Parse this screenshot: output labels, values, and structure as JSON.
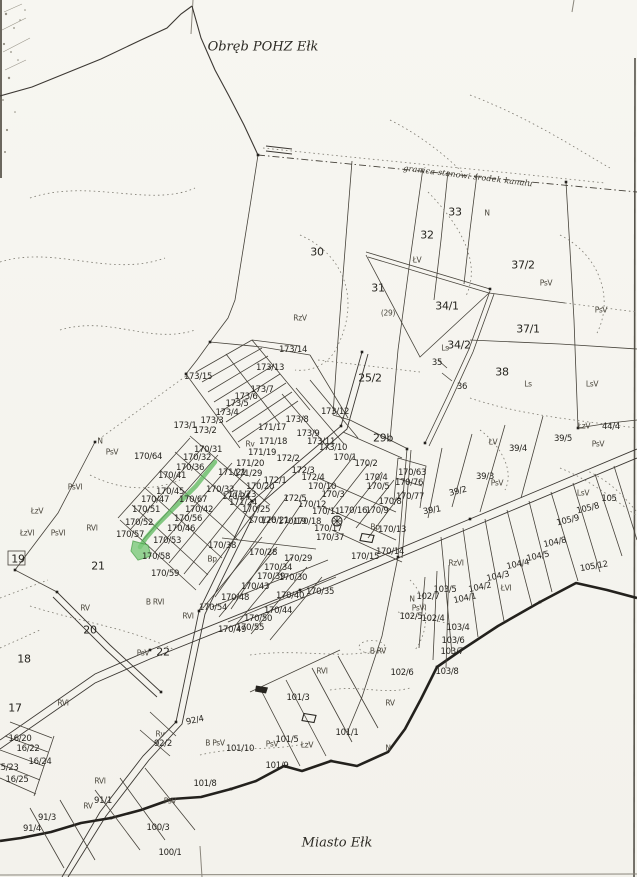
{
  "map": {
    "region_title": "Obręb POHZ Ełk",
    "city_title": "Miasto Ełk",
    "boundary_note": "granica stanowi środek kanału",
    "highlight_color": "#5cb85c",
    "highlight_fill": "#7ccb7c"
  },
  "highlight": {
    "line_points": "215,462 196,486 176,506 158,524 146,538 140,547",
    "blob_points": "133,541 148,545 151,556 138,560 131,551"
  },
  "labels": [
    {
      "t": "30",
      "x": 317,
      "y": 252,
      "c": "b"
    },
    {
      "t": "31",
      "x": 378,
      "y": 288,
      "c": "b"
    },
    {
      "t": "(29)",
      "x": 388,
      "y": 313,
      "c": "u"
    },
    {
      "t": "32",
      "x": 427,
      "y": 235,
      "c": "b"
    },
    {
      "t": "33",
      "x": 455,
      "y": 212,
      "c": "b"
    },
    {
      "t": "N",
      "x": 487,
      "y": 213,
      "c": "u"
    },
    {
      "t": "ŁV",
      "x": 417,
      "y": 260,
      "c": "u"
    },
    {
      "t": "RzV",
      "x": 300,
      "y": 318,
      "c": "u"
    },
    {
      "t": "34/1",
      "x": 447,
      "y": 306,
      "c": "b"
    },
    {
      "t": "Ls",
      "x": 445,
      "y": 348,
      "c": "u"
    },
    {
      "t": "34/2",
      "x": 459,
      "y": 345,
      "c": "b"
    },
    {
      "t": "35",
      "x": 437,
      "y": 363
    },
    {
      "t": "36",
      "x": 462,
      "y": 387
    },
    {
      "t": "37/2",
      "x": 523,
      "y": 265,
      "c": "b"
    },
    {
      "t": "PsV",
      "x": 546,
      "y": 283,
      "c": "u"
    },
    {
      "t": "PsV",
      "x": 601,
      "y": 310,
      "c": "u"
    },
    {
      "t": "37/1",
      "x": 528,
      "y": 329,
      "c": "b"
    },
    {
      "t": "38",
      "x": 502,
      "y": 372,
      "c": "b"
    },
    {
      "t": "Ls",
      "x": 528,
      "y": 384,
      "c": "u"
    },
    {
      "t": "LsV",
      "x": 592,
      "y": 384,
      "c": "u"
    },
    {
      "t": "25/2",
      "x": 370,
      "y": 378,
      "c": "b"
    },
    {
      "t": "29b",
      "x": 383,
      "y": 438,
      "c": "b"
    },
    {
      "t": "ŁzV",
      "x": 584,
      "y": 426,
      "c": "u"
    },
    {
      "t": "44/4",
      "x": 611,
      "y": 427
    },
    {
      "t": "39/5",
      "x": 563,
      "y": 439
    },
    {
      "t": "PsV",
      "x": 598,
      "y": 444,
      "c": "u"
    },
    {
      "t": "ŁV",
      "x": 493,
      "y": 442,
      "c": "u"
    },
    {
      "t": "39/4",
      "x": 518,
      "y": 449
    },
    {
      "t": "39/3",
      "x": 485,
      "y": 477
    },
    {
      "t": "PsV",
      "x": 497,
      "y": 483,
      "c": "u"
    },
    {
      "t": "39/2",
      "x": 458,
      "y": 492,
      "r": -14
    },
    {
      "t": "39/1",
      "x": 432,
      "y": 511,
      "r": -10
    },
    {
      "t": "LsV",
      "x": 583,
      "y": 493,
      "c": "u"
    },
    {
      "t": "105",
      "x": 609,
      "y": 499
    },
    {
      "t": "105/8",
      "x": 588,
      "y": 509,
      "r": -14
    },
    {
      "t": "105/9",
      "x": 568,
      "y": 521,
      "r": -14
    },
    {
      "t": "105/12",
      "x": 594,
      "y": 567,
      "r": -10
    },
    {
      "t": "104/8",
      "x": 555,
      "y": 543,
      "r": -12
    },
    {
      "t": "104/5",
      "x": 538,
      "y": 557,
      "r": -12
    },
    {
      "t": "104/4",
      "x": 518,
      "y": 565,
      "r": -12
    },
    {
      "t": "104/3",
      "x": 498,
      "y": 577,
      "r": -12
    },
    {
      "t": "104/2",
      "x": 480,
      "y": 588,
      "r": -12
    },
    {
      "t": "ŁVI",
      "x": 506,
      "y": 588,
      "c": "u"
    },
    {
      "t": "104/1",
      "x": 465,
      "y": 599,
      "r": -12
    },
    {
      "t": "RzVI",
      "x": 456,
      "y": 563,
      "c": "u"
    },
    {
      "t": "103/5",
      "x": 445,
      "y": 590
    },
    {
      "t": "102/7",
      "x": 428,
      "y": 597
    },
    {
      "t": "N",
      "x": 412,
      "y": 599,
      "c": "u"
    },
    {
      "t": "PsVI",
      "x": 419,
      "y": 608,
      "c": "u"
    },
    {
      "t": "102/5",
      "x": 411,
      "y": 617
    },
    {
      "t": "102/4",
      "x": 433,
      "y": 619
    },
    {
      "t": "103/4",
      "x": 458,
      "y": 628
    },
    {
      "t": "103/6",
      "x": 453,
      "y": 641
    },
    {
      "t": "103/7",
      "x": 452,
      "y": 652
    },
    {
      "t": "103/8",
      "x": 447,
      "y": 672
    },
    {
      "t": "102/6",
      "x": 402,
      "y": 673
    },
    {
      "t": "RVI",
      "x": 322,
      "y": 671,
      "c": "u"
    },
    {
      "t": "B RV",
      "x": 378,
      "y": 651,
      "c": "u"
    },
    {
      "t": "RV",
      "x": 390,
      "y": 703,
      "c": "u"
    },
    {
      "t": "101/3",
      "x": 298,
      "y": 698
    },
    {
      "t": "101/1",
      "x": 347,
      "y": 733
    },
    {
      "t": "ŁzV",
      "x": 307,
      "y": 745,
      "c": "u"
    },
    {
      "t": "N",
      "x": 388,
      "y": 748,
      "c": "u"
    },
    {
      "t": "101/5",
      "x": 287,
      "y": 740
    },
    {
      "t": "101/10",
      "x": 240,
      "y": 749
    },
    {
      "t": "PsV",
      "x": 272,
      "y": 744,
      "c": "u"
    },
    {
      "t": "B PsV",
      "x": 215,
      "y": 743,
      "c": "u"
    },
    {
      "t": "101/9",
      "x": 277,
      "y": 766
    },
    {
      "t": "101/8",
      "x": 205,
      "y": 784
    },
    {
      "t": "100/3",
      "x": 158,
      "y": 828
    },
    {
      "t": "100/1",
      "x": 170,
      "y": 853
    },
    {
      "t": "PsV",
      "x": 170,
      "y": 801,
      "c": "u"
    },
    {
      "t": "92/4",
      "x": 195,
      "y": 721,
      "r": -12
    },
    {
      "t": "Rv",
      "x": 160,
      "y": 734,
      "c": "u"
    },
    {
      "t": "92/2",
      "x": 163,
      "y": 744
    },
    {
      "t": "91/1",
      "x": 103,
      "y": 801
    },
    {
      "t": "RV",
      "x": 88,
      "y": 806,
      "c": "u"
    },
    {
      "t": "RVI",
      "x": 100,
      "y": 781,
      "c": "u"
    },
    {
      "t": "91/3",
      "x": 47,
      "y": 818
    },
    {
      "t": "91/4",
      "x": 32,
      "y": 829
    },
    {
      "t": "16/20",
      "x": 20,
      "y": 739
    },
    {
      "t": "16/22",
      "x": 28,
      "y": 749
    },
    {
      "t": "16/24",
      "x": 40,
      "y": 762
    },
    {
      "t": "15/23",
      "x": 7,
      "y": 768
    },
    {
      "t": "16/25",
      "x": 17,
      "y": 780
    },
    {
      "t": "17",
      "x": 15,
      "y": 708,
      "c": "b"
    },
    {
      "t": "18",
      "x": 24,
      "y": 659,
      "c": "b"
    },
    {
      "t": "19",
      "x": 18,
      "y": 559,
      "c": "b"
    },
    {
      "t": "RVI",
      "x": 63,
      "y": 703,
      "c": "u"
    },
    {
      "t": "20",
      "x": 90,
      "y": 630,
      "c": "b"
    },
    {
      "t": "RV",
      "x": 85,
      "y": 608,
      "c": "u"
    },
    {
      "t": "B RVI",
      "x": 155,
      "y": 602,
      "c": "u"
    },
    {
      "t": "RVI",
      "x": 188,
      "y": 616,
      "c": "u"
    },
    {
      "t": "PsV",
      "x": 143,
      "y": 653,
      "c": "u"
    },
    {
      "t": "22",
      "x": 163,
      "y": 652,
      "c": "b"
    },
    {
      "t": "21",
      "x": 98,
      "y": 566,
      "c": "b"
    },
    {
      "t": "PsVI",
      "x": 75,
      "y": 487,
      "c": "u"
    },
    {
      "t": "ŁzV",
      "x": 37,
      "y": 511,
      "c": "u"
    },
    {
      "t": "ŁzVI",
      "x": 27,
      "y": 533,
      "c": "u"
    },
    {
      "t": "PsVI",
      "x": 58,
      "y": 533,
      "c": "u"
    },
    {
      "t": "RVI",
      "x": 92,
      "y": 528,
      "c": "u"
    },
    {
      "t": "N",
      "x": 100,
      "y": 441,
      "c": "u"
    },
    {
      "t": "PsV",
      "x": 112,
      "y": 452,
      "c": "u"
    },
    {
      "t": "173/14",
      "x": 293,
      "y": 350
    },
    {
      "t": "173/13",
      "x": 270,
      "y": 368
    },
    {
      "t": "173/15",
      "x": 198,
      "y": 377
    },
    {
      "t": "173/12",
      "x": 335,
      "y": 412
    },
    {
      "t": "173/7",
      "x": 262,
      "y": 390
    },
    {
      "t": "173/6",
      "x": 246,
      "y": 397
    },
    {
      "t": "173/5",
      "x": 237,
      "y": 404
    },
    {
      "t": "173/4",
      "x": 227,
      "y": 413
    },
    {
      "t": "173/3",
      "x": 212,
      "y": 421
    },
    {
      "t": "173/2",
      "x": 205,
      "y": 431
    },
    {
      "t": "173/1",
      "x": 185,
      "y": 426
    },
    {
      "t": "173/8",
      "x": 297,
      "y": 420
    },
    {
      "t": "173/9",
      "x": 308,
      "y": 434
    },
    {
      "t": "173/11",
      "x": 321,
      "y": 442
    },
    {
      "t": "173/10",
      "x": 333,
      "y": 448
    },
    {
      "t": "171/17",
      "x": 272,
      "y": 428
    },
    {
      "t": "171/18",
      "x": 273,
      "y": 442
    },
    {
      "t": "171/19",
      "x": 262,
      "y": 453
    },
    {
      "t": "171/20",
      "x": 250,
      "y": 464
    },
    {
      "t": "171/29",
      "x": 248,
      "y": 474
    },
    {
      "t": "171/21",
      "x": 232,
      "y": 473
    },
    {
      "t": "171/23",
      "x": 242,
      "y": 495
    },
    {
      "t": "171/24",
      "x": 243,
      "y": 503
    },
    {
      "t": "Rv",
      "x": 250,
      "y": 444,
      "c": "u"
    },
    {
      "t": "172/2",
      "x": 288,
      "y": 459
    },
    {
      "t": "172/3",
      "x": 303,
      "y": 471
    },
    {
      "t": "172/4",
      "x": 313,
      "y": 478
    },
    {
      "t": "172/1",
      "x": 275,
      "y": 481
    },
    {
      "t": "172/5",
      "x": 295,
      "y": 499
    },
    {
      "t": "170/64",
      "x": 148,
      "y": 457
    },
    {
      "t": "170/31",
      "x": 208,
      "y": 450
    },
    {
      "t": "170/32",
      "x": 197,
      "y": 458
    },
    {
      "t": "170/36",
      "x": 190,
      "y": 468
    },
    {
      "t": "170/41",
      "x": 172,
      "y": 476
    },
    {
      "t": "170/45",
      "x": 170,
      "y": 492
    },
    {
      "t": "170/33",
      "x": 220,
      "y": 490
    },
    {
      "t": "170/24",
      "x": 236,
      "y": 497
    },
    {
      "t": "170/47",
      "x": 155,
      "y": 500
    },
    {
      "t": "170/67",
      "x": 193,
      "y": 500
    },
    {
      "t": "170/51",
      "x": 146,
      "y": 510
    },
    {
      "t": "170/42",
      "x": 199,
      "y": 510
    },
    {
      "t": "170/56",
      "x": 188,
      "y": 519
    },
    {
      "t": "170/52",
      "x": 139,
      "y": 523
    },
    {
      "t": "170/46",
      "x": 181,
      "y": 529
    },
    {
      "t": "170/57",
      "x": 130,
      "y": 535
    },
    {
      "t": "170/53",
      "x": 167,
      "y": 541
    },
    {
      "t": "170/58",
      "x": 156,
      "y": 557
    },
    {
      "t": "170/59",
      "x": 165,
      "y": 574
    },
    {
      "t": "170/38",
      "x": 222,
      "y": 546
    },
    {
      "t": "Bp",
      "x": 212,
      "y": 559,
      "c": "u"
    },
    {
      "t": "170/20",
      "x": 260,
      "y": 487
    },
    {
      "t": "170/25",
      "x": 256,
      "y": 510
    },
    {
      "t": "170/26",
      "x": 262,
      "y": 521
    },
    {
      "t": "170/21",
      "x": 275,
      "y": 521
    },
    {
      "t": "170/19",
      "x": 292,
      "y": 522
    },
    {
      "t": "170/18",
      "x": 307,
      "y": 522
    },
    {
      "t": "170/17",
      "x": 328,
      "y": 529
    },
    {
      "t": "170/37",
      "x": 330,
      "y": 538
    },
    {
      "t": "170/1",
      "x": 345,
      "y": 458
    },
    {
      "t": "170/2",
      "x": 366,
      "y": 464
    },
    {
      "t": "170/4",
      "x": 376,
      "y": 478
    },
    {
      "t": "170/5",
      "x": 378,
      "y": 487
    },
    {
      "t": "170/10",
      "x": 322,
      "y": 487
    },
    {
      "t": "170/3",
      "x": 333,
      "y": 495
    },
    {
      "t": "170/12",
      "x": 312,
      "y": 505
    },
    {
      "t": "170/11",
      "x": 326,
      "y": 512
    },
    {
      "t": "170/16",
      "x": 353,
      "y": 511
    },
    {
      "t": "170/9",
      "x": 377,
      "y": 511
    },
    {
      "t": "170/8",
      "x": 390,
      "y": 502
    },
    {
      "t": "170/13",
      "x": 392,
      "y": 530
    },
    {
      "t": "Bp",
      "x": 375,
      "y": 527,
      "c": "u"
    },
    {
      "t": "170/14",
      "x": 390,
      "y": 552
    },
    {
      "t": "170/15",
      "x": 365,
      "y": 557
    },
    {
      "t": "170/63",
      "x": 412,
      "y": 473
    },
    {
      "t": "170/76",
      "x": 409,
      "y": 483
    },
    {
      "t": "170/77",
      "x": 410,
      "y": 497
    },
    {
      "t": "170/28",
      "x": 263,
      "y": 553
    },
    {
      "t": "170/29",
      "x": 298,
      "y": 559
    },
    {
      "t": "170/34",
      "x": 278,
      "y": 568
    },
    {
      "t": "170/39",
      "x": 271,
      "y": 577
    },
    {
      "t": "170/30",
      "x": 293,
      "y": 578
    },
    {
      "t": "170/43",
      "x": 255,
      "y": 587
    },
    {
      "t": "170/35",
      "x": 320,
      "y": 592
    },
    {
      "t": "170/40",
      "x": 290,
      "y": 596
    },
    {
      "t": "170/48",
      "x": 235,
      "y": 598
    },
    {
      "t": "170/54",
      "x": 213,
      "y": 608
    },
    {
      "t": "170/44",
      "x": 278,
      "y": 611
    },
    {
      "t": "170/50",
      "x": 258,
      "y": 619
    },
    {
      "t": "170/55",
      "x": 250,
      "y": 628
    },
    {
      "t": "170/49",
      "x": 232,
      "y": 630
    }
  ],
  "symbols": [
    {
      "name": "circled-cross-symbol",
      "x": 337,
      "y": 521
    },
    {
      "name": "building-outline",
      "x": 368,
      "y": 538
    },
    {
      "name": "building-outline",
      "x": 310,
      "y": 718
    },
    {
      "name": "building-filled",
      "x": 262,
      "y": 689
    }
  ]
}
